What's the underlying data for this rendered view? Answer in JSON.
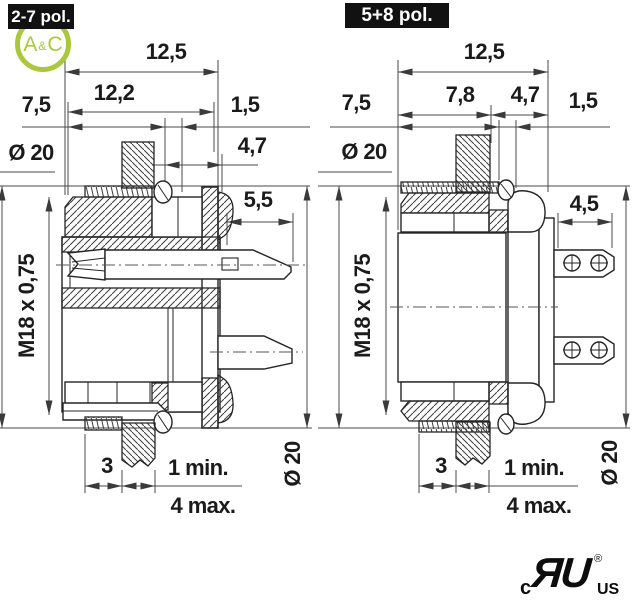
{
  "figures": {
    "left": {
      "title": "2-7 pol.",
      "dims": {
        "overall_width": "12,5",
        "body_width": "12,2",
        "front_length": "7,5",
        "flange_thickness": "1,5",
        "rear_offset": "4,7",
        "front_diameter": "Ø 20",
        "contact_length": "5,5",
        "thread": "M18 x 0,75",
        "nut_depth": "3",
        "panel_min": "1 min.",
        "panel_max": "4 max.",
        "rear_diameter": "Ø 20"
      }
    },
    "right": {
      "title": "5+8 pol.",
      "dims": {
        "overall_width": "12,5",
        "front_segment": "7,8",
        "rear_segment": "4,7",
        "front_length": "7,5",
        "flange_thickness": "1,5",
        "front_diameter": "Ø 20",
        "lug_length": "4,5",
        "thread": "M18 x 0,75",
        "nut_depth": "3",
        "panel_min": "1 min.",
        "panel_max": "4 max.",
        "rear_diameter": "Ø 20"
      }
    }
  },
  "logo": {
    "letter_a": "A",
    "ampersand": "&",
    "letter_c": "C",
    "brand_color": "#a9c83b"
  },
  "certification": {
    "country_prefix": "c",
    "monogram": "ЯU",
    "registered_symbol": "®",
    "country_suffix": "US"
  },
  "colors": {
    "outline": "#252525",
    "dimension_lines": "#4a4a4a",
    "chip_bg": "#111111",
    "chip_text": "#ffffff"
  }
}
